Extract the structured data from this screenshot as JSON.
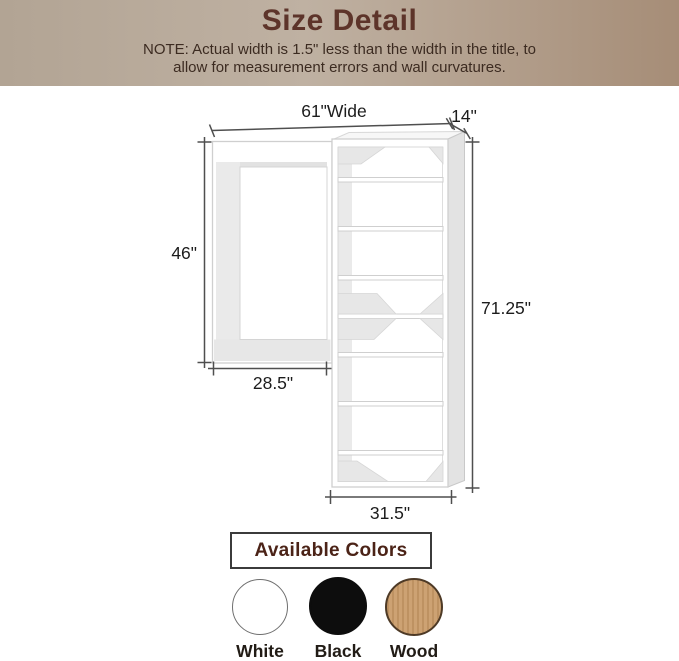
{
  "header": {
    "title": "Size Detail",
    "note_line1": "NOTE: Actual width is 1.5\" less than the width in the title, to",
    "note_line2": "allow for measurement errors and wall curvatures."
  },
  "diagram": {
    "dimensions": {
      "total_width": "61\"Wide",
      "depth": "14\"",
      "hanging_height": "46\"",
      "hanging_width": "28.5\"",
      "total_height": "71.25\"",
      "tower_width": "31.5\""
    }
  },
  "colors_section": {
    "title": "Available Colors",
    "options": [
      {
        "name": "White",
        "hex": "#ffffff"
      },
      {
        "name": "Black",
        "hex": "#0d0d0d"
      },
      {
        "name": "Wood",
        "hex": "#cda273"
      }
    ]
  },
  "palette": {
    "header_gradient_left": "#b2a494",
    "header_gradient_right": "#a68d77",
    "title_color": "#5d342a",
    "note_color": "#3c2b21",
    "dimension_line": "#4f4f4f",
    "unit_outline": "#cfcfcf",
    "unit_shading": "#e7e7e7",
    "colors_box_border": "#3b3b3b"
  }
}
